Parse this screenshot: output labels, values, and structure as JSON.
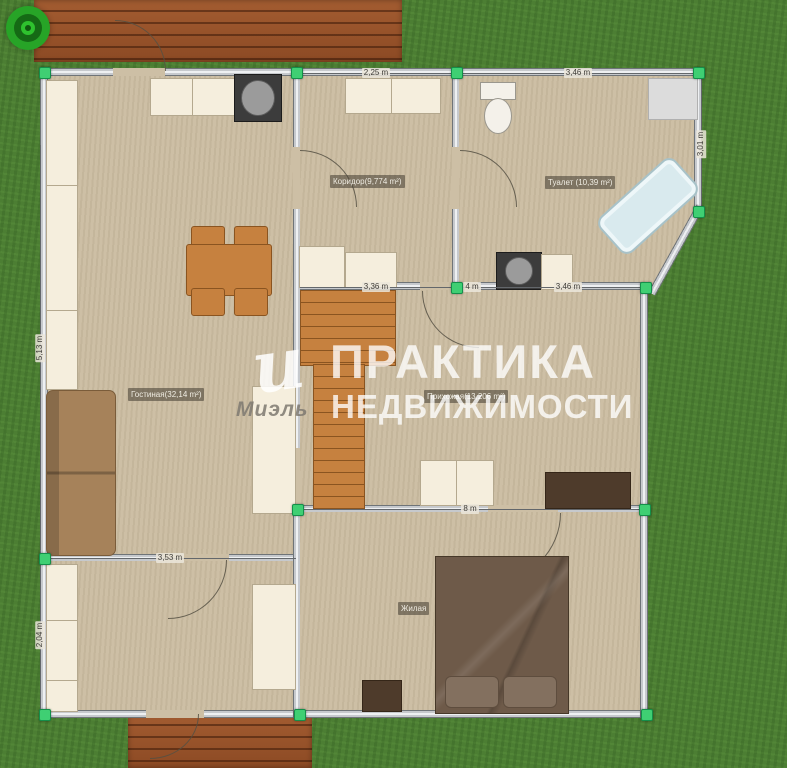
{
  "watermark": {
    "line1": "ПРАКТИКА",
    "line2": "НЕДВИЖИМОСТИ",
    "logo_glyph": "и",
    "brand": "Миэль"
  },
  "rooms": {
    "corridor": {
      "label": "Коридор(9,774 m²)"
    },
    "toilet": {
      "label": "Туалет (10,39 m²)"
    },
    "living": {
      "label": "Гостиная(32,14 m²)"
    },
    "hall": {
      "label": "Прихожая(13,206 m²)"
    },
    "bedroom": {
      "label": "Жилая"
    }
  },
  "dimensions": {
    "top_corridor": "2,25 m",
    "top_toilet": "3,46 m",
    "right_toilet": "3,01 m",
    "mid_left": "3,36 m",
    "mid_small": "4 m",
    "mid_right": "3,46 m",
    "hall_bottom": "8 m",
    "bottomleft_top": "3,53 m",
    "left_living": "5,13 m",
    "left_bottom": "2,04 m"
  },
  "icons": {
    "target": "target-marker-icon"
  },
  "colors": {
    "grass": "#4c7e33",
    "floor": "#cdbfa5",
    "wall": "#9aa0a6",
    "accent_green": "#3fcf73",
    "wood": "#c6813f",
    "dark_wood": "#4e3b2b",
    "bed": "#6e5a49",
    "tub": "#d9eaee",
    "cream": "#f5eedd"
  }
}
